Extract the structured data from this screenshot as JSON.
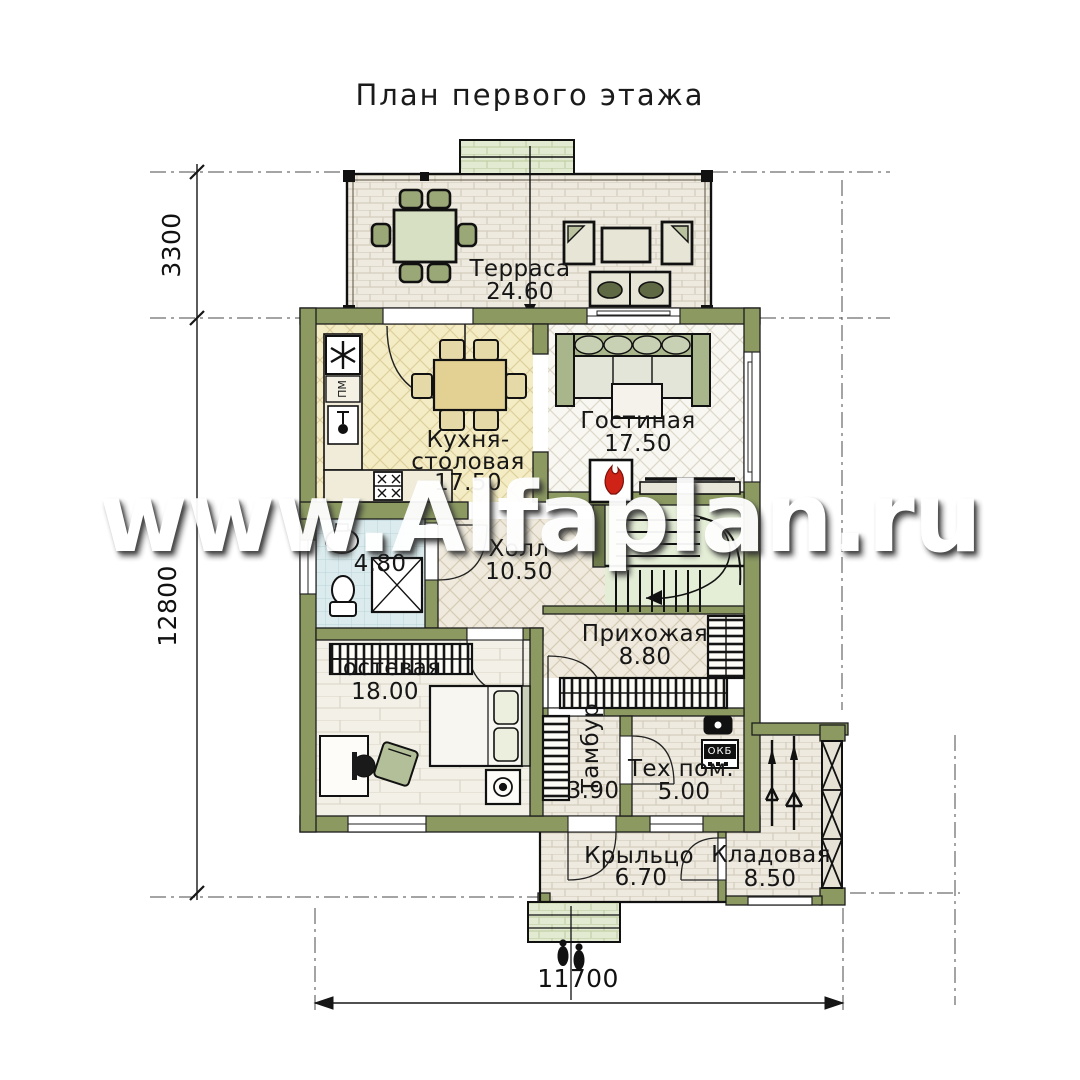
{
  "title": "План первого этажа",
  "watermark": "www.Alfaplan.ru",
  "rooms": {
    "terrace": {
      "name": "Терраса",
      "area": "24.60"
    },
    "kitchen": {
      "name": "Кухня-столовая",
      "area": "17.50"
    },
    "living": {
      "name": "Гостиная",
      "area": "17.50"
    },
    "hall": {
      "name": "Холл",
      "area": "10.50"
    },
    "bathroom": {
      "area": "4.80"
    },
    "guest": {
      "name": "Гостевая",
      "area": "18.00"
    },
    "entry": {
      "name": "Прихожая",
      "area": "8.80"
    },
    "vestibule": {
      "name": "Тамбур",
      "area": "3.90"
    },
    "tech": {
      "name": "Тех пом.",
      "area": "5.00"
    },
    "porch": {
      "name": "Крыльцо",
      "area": "6.70"
    },
    "storage": {
      "name": "Кладовая",
      "area": "8.50"
    }
  },
  "dimensions": {
    "terrace_depth": "3300",
    "house_depth": "12800",
    "total_width": "11700"
  },
  "equipment": {
    "dishwasher": "ПМ",
    "boiler": "ОКБ"
  },
  "colors": {
    "wall": "#8c9a62",
    "flame": "#cf2318",
    "terrace_floor": "#eeeadf",
    "kitchen_floor": "#f4ecc4",
    "bath_floor": "#dcecee",
    "stairs_floor": "#e4edd6"
  }
}
